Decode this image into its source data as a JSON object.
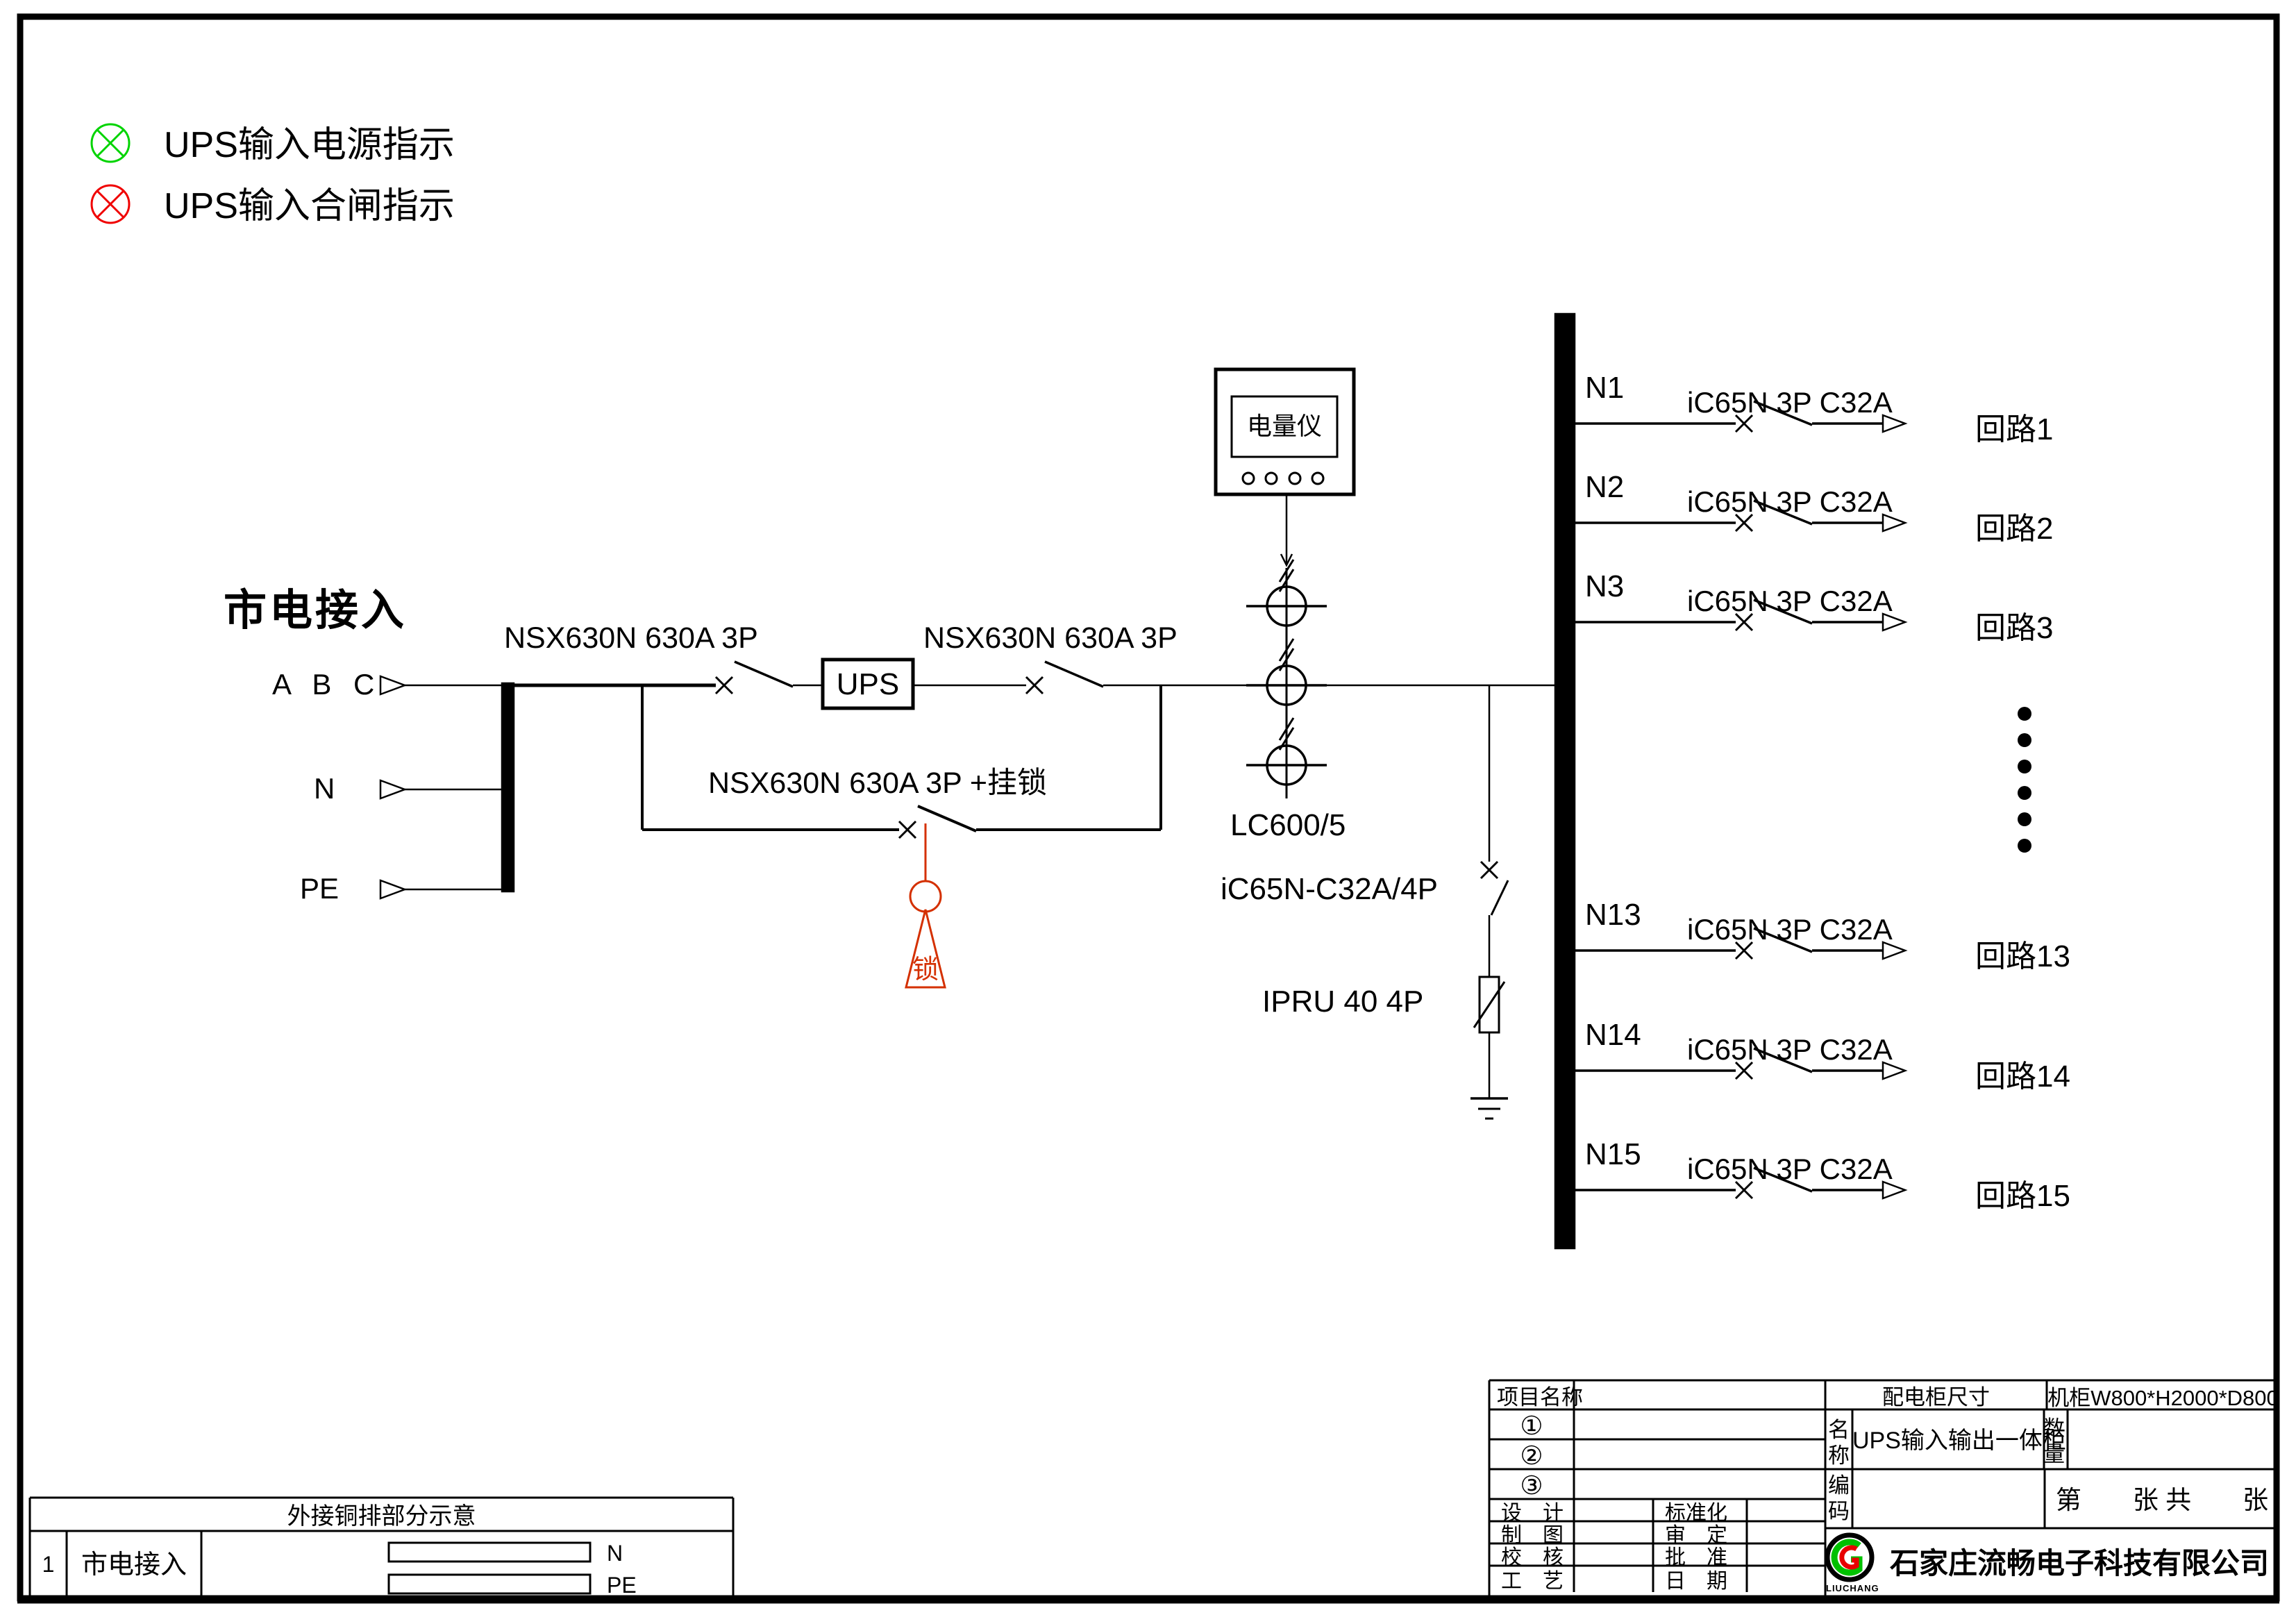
{
  "legend": {
    "items": [
      {
        "icon": "indicator-lamp-green-icon",
        "color": "#00d400",
        "label": "UPS输入电源指示"
      },
      {
        "icon": "indicator-lamp-red-icon",
        "color": "#f00000",
        "label": "UPS输入合闸指示"
      }
    ]
  },
  "source": {
    "title": "市电接入",
    "phase_label": "A B C",
    "neutral_label": "N",
    "earth_label": "PE"
  },
  "components": {
    "input_breaker": "NSX630N  630A 3P",
    "ups": "UPS",
    "output_breaker": "NSX630N  630A 3P",
    "bypass_breaker": "NSX630N  630A 3P +挂锁",
    "lock_char": "锁",
    "meter": "电量仪",
    "ct": "LC600/5",
    "spd_breaker": "iC65N-C32A/4P",
    "spd": "IPRU 40 4P"
  },
  "branches": [
    {
      "id": "N1",
      "breaker": "iC65N 3P C32A",
      "circuit": "回路1"
    },
    {
      "id": "N2",
      "breaker": "iC65N 3P C32A",
      "circuit": "回路2"
    },
    {
      "id": "N3",
      "breaker": "iC65N 3P C32A",
      "circuit": "回路3"
    },
    {
      "id": "N13",
      "breaker": "iC65N 3P C32A",
      "circuit": "回路13"
    },
    {
      "id": "N14",
      "breaker": "iC65N 3P C32A",
      "circuit": "回路14"
    },
    {
      "id": "N15",
      "breaker": "iC65N 3P C32A",
      "circuit": "回路15"
    }
  ],
  "bottom_table": {
    "title": "外接铜排部分示意",
    "row_no": "1",
    "row_label": "市电接入",
    "bar_n_label": "N",
    "bar_pe_label": "PE"
  },
  "title_block": {
    "project_label": "项目名称",
    "rev1": "①",
    "rev2": "②",
    "rev3": "③",
    "design_label": "设　计",
    "draft_label": "制　图",
    "check_label": "校　核",
    "process_label": "工　艺",
    "standard_label": "标准化",
    "approve_label": "审　定",
    "ratify_label": "批　准",
    "date_label": "日　期",
    "cabinet_size_label": "配电柜尺寸",
    "cabinet_size_value": "机柜W800*H2000*D800",
    "name_label": "名称",
    "name_value": "UPS输入输出一体柜",
    "qty_label": "数量",
    "code_label": "编码",
    "sheet_text": "第　　张 共　　张",
    "company": "石家庄流畅电子科技有限公司",
    "logo_text": "LIUCHANG"
  }
}
